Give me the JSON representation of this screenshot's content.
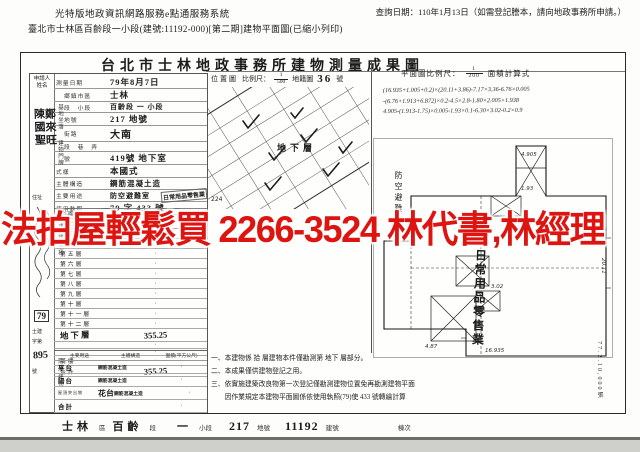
{
  "page_header": {
    "system_title": "光特版地政資訊網路服務e點通服務系統",
    "query_date": "查詢日期：110年1月13日（如需登記謄本，請向地政事務所申請。）",
    "subtitle": "臺北市士林區百齡段一小段(建號:11192-000)[第二期]建物平面圖(已縮小列印)"
  },
  "overlay": {
    "ad_text": "法拍屋輕鬆買 2266-3524 林代書,林經理",
    "color": "#dd1410"
  },
  "document": {
    "title": "台北市士林地政事務所建物測量成果圖",
    "applicant": {
      "label_line1": "申請人",
      "label_line2": "姓名",
      "names": [
        "陳國聖",
        "鄭來旺"
      ],
      "address_label": "住址",
      "receipt_stamp": "79",
      "receipt_prefix": "士建",
      "receipt_zi": "字第",
      "receipt_no": "895",
      "receipt_suffix": "號"
    },
    "fields": {
      "survey_date_label": "測量日期",
      "survey_date": "79年8月7日",
      "site_group_label": "基地坐落",
      "district_label": "鄉鎮市區",
      "district": "士林",
      "section_label": "段　小段",
      "section": "百齡段 一 小段",
      "lot_label": "地號",
      "lot": "217 地號",
      "door_group_label": "建物門牌",
      "street_label": "街路",
      "street": "大南",
      "lane_label": "段　巷　弄",
      "lane": "",
      "door_no_label": "號",
      "door_no": "419號 地下室",
      "style_label": "式樣",
      "style": "本國式",
      "structure_label": "主體構造",
      "structure": "鋼筋混凝土造",
      "use_label": "主要用途",
      "use": "防空避難室",
      "use_stamp": "日常用品零售業",
      "license_label": "使用執照",
      "license": "79 字 433 號"
    },
    "floor_table": {
      "side_label": "建物面積",
      "rows": [
        {
          "label": "地面層",
          "value": "·"
        },
        {
          "label": "第二層",
          "value": "·"
        },
        {
          "label": "第三層",
          "value": "·"
        },
        {
          "label": "第四層",
          "value": "·"
        },
        {
          "label": "第五層",
          "value": "·"
        },
        {
          "label": "第六層",
          "value": "·"
        },
        {
          "label": "第七層",
          "value": "·"
        },
        {
          "label": "第八層",
          "value": "·"
        },
        {
          "label": "第九層",
          "value": "·"
        },
        {
          "label": "第十層",
          "value": "·"
        },
        {
          "label": "第十一層",
          "value": "·"
        },
        {
          "label": "第十二層",
          "value": "·"
        },
        {
          "label": "地下層",
          "value": "355.25"
        },
        {
          "label": "",
          "value": "·"
        },
        {
          "label": "",
          "value": "·"
        },
        {
          "label": "騎樓",
          "value": "·"
        },
        {
          "label": "合計",
          "value": "355.25"
        }
      ]
    },
    "annex_table": {
      "side_label": "附屬建物",
      "headers": [
        "主要用途",
        "主體構造",
        "面積(平方公尺)"
      ],
      "rows": [
        {
          "use": "平台",
          "structure": "鋼筋混凝土造",
          "area": "·"
        },
        {
          "use": "陽台",
          "structure": "鋼筋混凝土造",
          "area": "·"
        },
        {
          "use": "屋頂突出物",
          "use_hw": "花台",
          "structure": "鋼筋混凝土造",
          "area": "·"
        },
        {
          "use": "合計",
          "structure": "",
          "area": "·"
        }
      ]
    },
    "location_map": {
      "label": "位置圖",
      "scale_label": "比例尺：",
      "scale_num": "1",
      "scale_den": "500",
      "sheet_label": "地籍圖",
      "sheet_no": "36",
      "sheet_suffix": "號",
      "parcel_no": "224"
    },
    "plan": {
      "scale_label": "平面圖比例尺：",
      "scale_num": "1",
      "scale_den": "200",
      "calc_label": "面積計算式",
      "formula": [
        "(16.935+1.005+0.2)×(20.11+3.86)-7.17×3.36-6.76×0.005",
        "-(6.76+1.913+6.872)×0.2-4.5×2.8-1.80×2.005+1.938",
        "4.905-(1.913-1.75)×0.005-1.93×0.1-6.30×3.02-0.2×0.9"
      ],
      "floor_label": "地下層",
      "room_label": "防空避難室",
      "use_label": "日常用品零售業",
      "dims": {
        "d1": "16.935",
        "d2": "4.87",
        "d3": "4.905",
        "d4": "3.02",
        "d5": "20.11",
        "d6": "1.93"
      },
      "print_code": "77.2.10,000張"
    },
    "notes": [
      "一、本建物係 拾 層建物本件僅勘測第 地下 層部分。",
      "二、本成果僅供建物登記之用。",
      "三、依實施建築改良物第一次登記僅勘測建物位置免再勘測建物平面",
      "　　因作業規定本建物平面圖係依使用執照(79)使 433 號轉繪計算"
    ],
    "footer": {
      "district": "士林",
      "district_suffix": "區",
      "section": "百齡",
      "section_suffix": "段",
      "subsection": "一",
      "subsection_suffix": "小段",
      "lot": "217",
      "lot_suffix": "地號",
      "building_no": "11192",
      "building_suffix": "建號",
      "unit_label": "棟次"
    }
  }
}
